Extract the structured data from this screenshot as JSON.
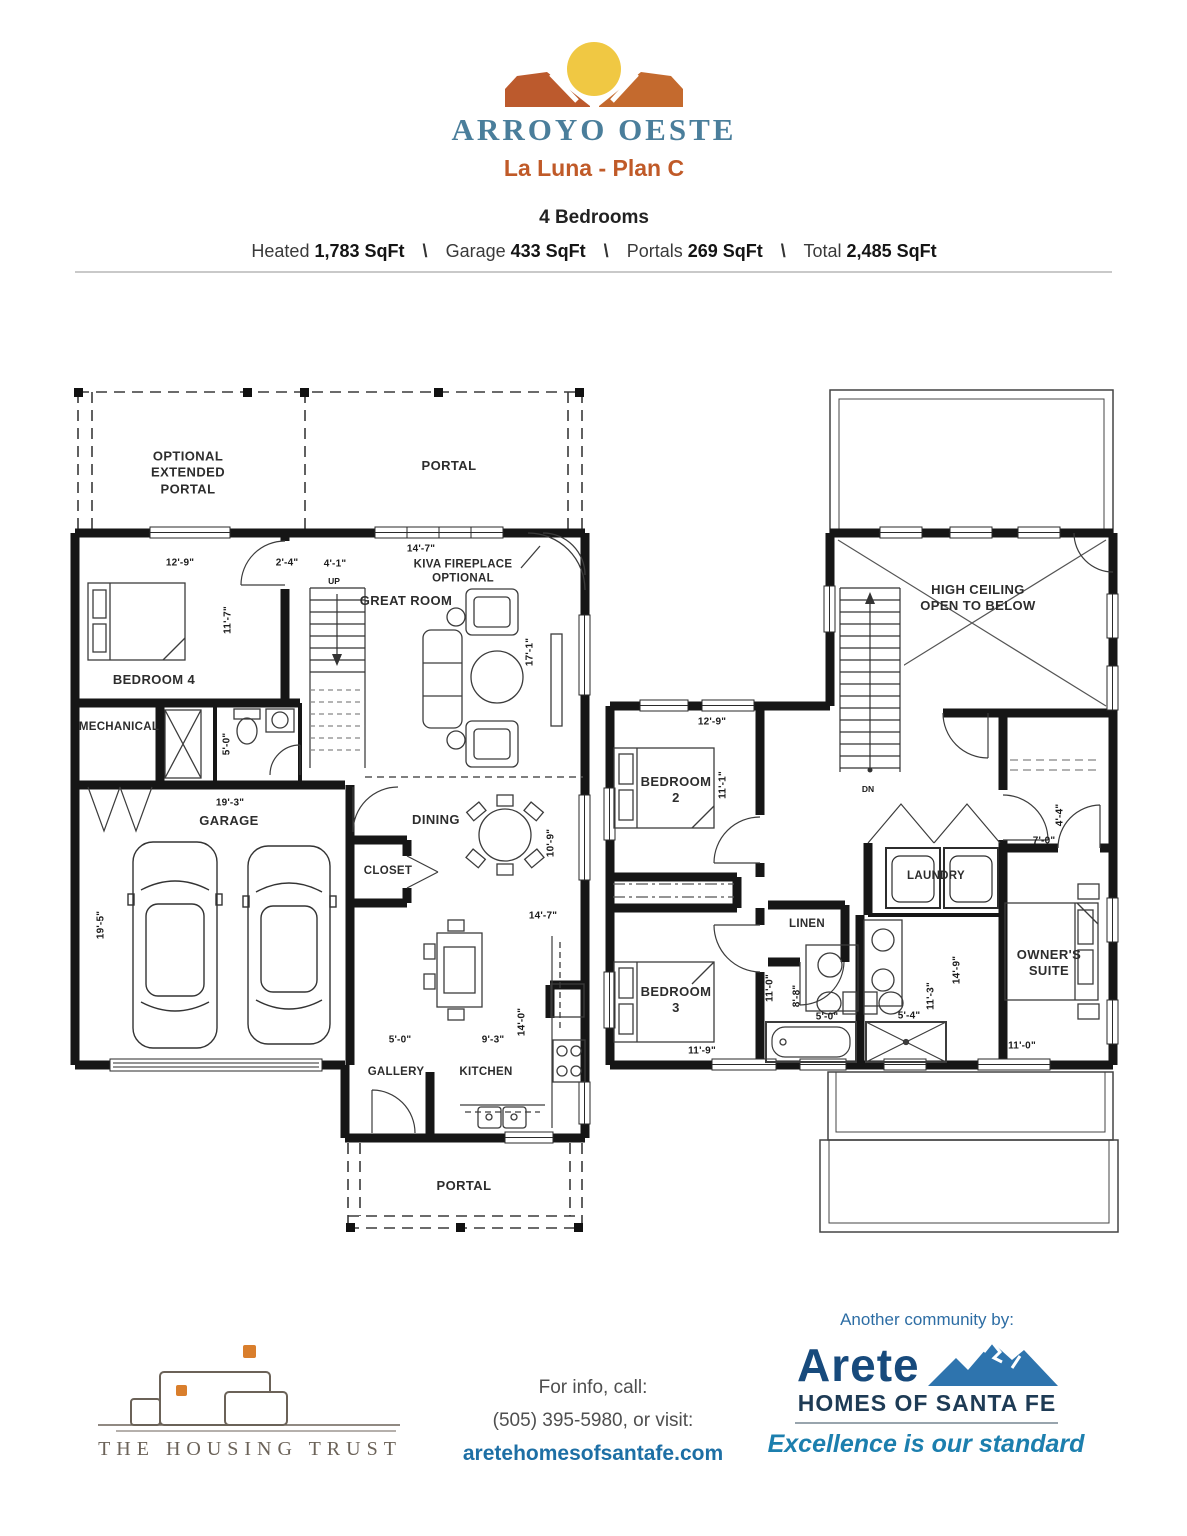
{
  "header": {
    "brand": "ARROYO OESTE",
    "plan": "La Luna - Plan C",
    "bedrooms": "4 Bedrooms",
    "sep": "\\",
    "stats": {
      "heated_label": "Heated",
      "heated": "1,783 SqFt",
      "garage_label": "Garage",
      "garage": "433 SqFt",
      "portals_label": "Portals",
      "portals": "269 SqFt",
      "total_label": "Total",
      "total": "2,485 SqFt"
    }
  },
  "floor1": {
    "optional_portal": "OPTIONAL\nEXTENDED\nPORTAL",
    "portal_top": "PORTAL",
    "kiva": "KIVA FIREPLACE\nOPTIONAL",
    "great_room": "GREAT ROOM",
    "bedroom4": "BEDROOM 4",
    "mechanical": "MECHANICAL",
    "garage": "GARAGE",
    "dining": "DINING",
    "closet": "CLOSET",
    "gallery": "GALLERY",
    "kitchen": "KITCHEN",
    "portal_bottom": "PORTAL",
    "up": "UP",
    "dims": {
      "bed4_w": "12'-9\"",
      "hall": "2'-4\"",
      "stair": "4'-1\"",
      "portal_w": "14'-7\"",
      "bed4_d": "11'-7\"",
      "great_d": "17'-1\"",
      "bath_d": "5'-0\"",
      "garage_w": "19'-3\"",
      "garage_d": "19'-5\"",
      "dining_d": "10'-9\"",
      "dining_w": "14'-7\"",
      "gallery_w": "5'-0\"",
      "island_w": "9'-3\"",
      "kitchen_d": "14'-0\""
    }
  },
  "floor2": {
    "high_ceiling": "HIGH CEILING\nOPEN TO BELOW",
    "bedroom2": "BEDROOM\n2",
    "bedroom3": "BEDROOM\n3",
    "laundry": "LAUNDRY",
    "linen": "LINEN",
    "owners_suite": "OWNER'S\nSUITE",
    "dn": "DN",
    "dims": {
      "bed2_w": "12'-9\"",
      "bed2_d": "11'-1\"",
      "bed3_d": "11'-0\"",
      "bath1_d": "8'-8\"",
      "bath1_w": "5'-0\"",
      "bath2_w": "5'-4\"",
      "bath2_d": "11'-3\"",
      "owner_d": "14'-9\"",
      "owner_w": "11'-0\"",
      "bed3_w": "11'-9\"",
      "closet_d": "4'-4\"",
      "closet_w": "7'-0\""
    }
  },
  "footer": {
    "trust_name": "THE HOUSING TRUST",
    "info_line1": "For info, call:",
    "info_line2": "(505) 395-5980, or visit:",
    "website": "aretehomesofsantafe.com",
    "community_by": "Another community by:",
    "arete": "Arete",
    "homes": "HOMES OF SANTA FE",
    "tagline": "Excellence is our standard"
  },
  "colors": {
    "brand_teal": "#4A7E9B",
    "brand_rust": "#C05A28",
    "sun_yellow": "#F0C843",
    "mesa_left": "#BC5A2D",
    "mesa_right": "#C46A2E",
    "arete_navy": "#174A7C",
    "arete_blue": "#2E74AE",
    "tagline_teal": "#1C7FAE",
    "link_blue": "#1D6FA5",
    "trust_gray": "#6B6258",
    "trust_orange": "#D97E2C"
  }
}
